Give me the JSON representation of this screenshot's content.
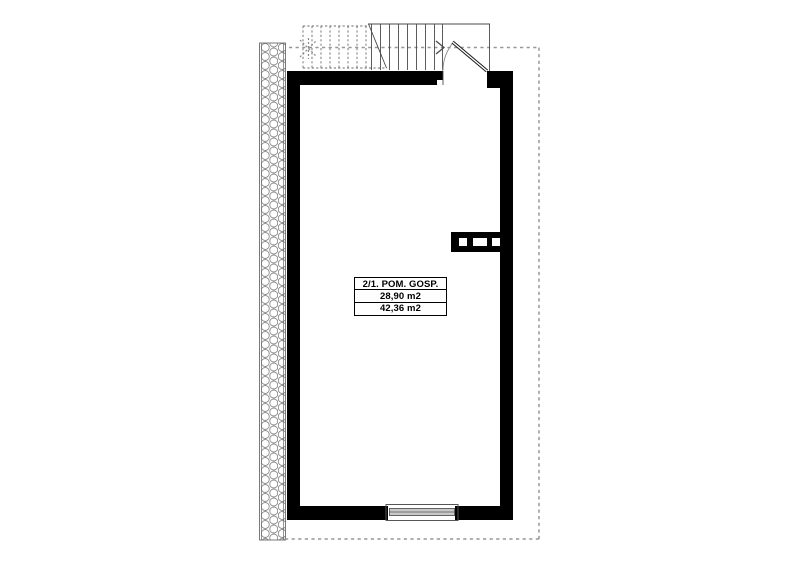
{
  "drawing": {
    "title": "floor-plan",
    "room_label": {
      "rows": [
        "2/1. POM. GOSP.",
        "28,90 m2",
        "42,36 m2"
      ]
    },
    "colors": {
      "wall": "#000000",
      "thin_line": "#3c3c3c",
      "stair_line": "#4a4a4a",
      "dashed_line": "#979797",
      "hatch": "#8a8a8a",
      "window_fill": "#c9c9c9",
      "window_edge": "#555555",
      "background": "#ffffff"
    }
  }
}
